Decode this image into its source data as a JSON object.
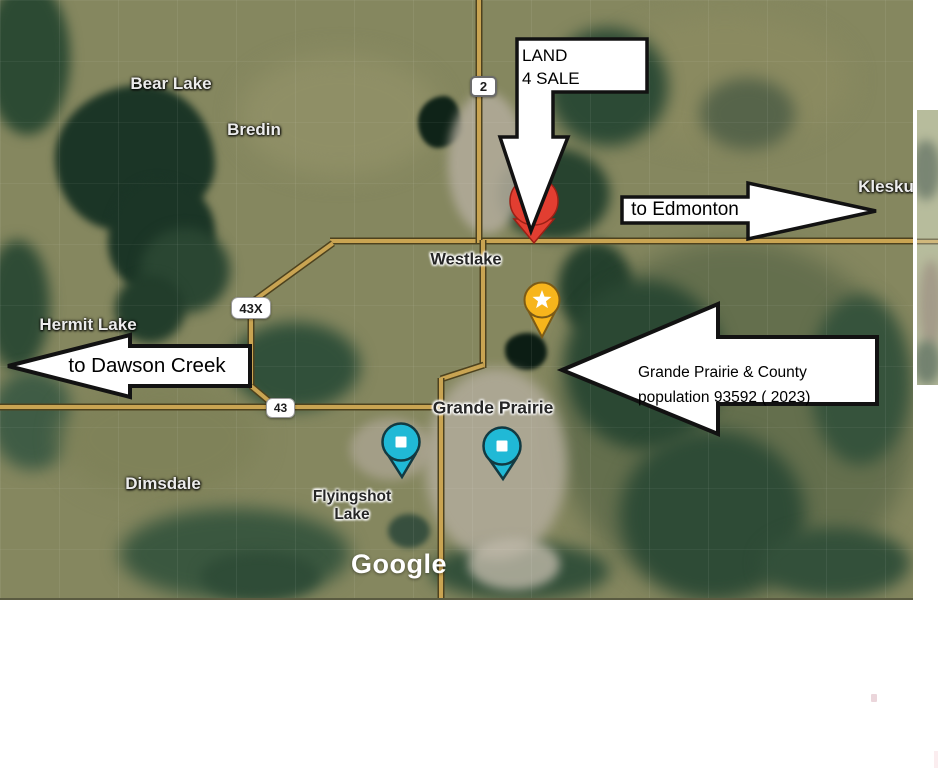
{
  "map": {
    "provider_logo": "Google",
    "labels": {
      "bear_lake": "Bear Lake",
      "bredin": "Bredin",
      "hermit_lake": "Hermit Lake",
      "westlake": "Westlake",
      "grande_prairie": "Grande Prairie",
      "dimsdale": "Dimsdale",
      "flyingshot_line1": "Flyingshot",
      "flyingshot_line2": "Lake",
      "kleskun": "Klesku"
    },
    "route_badges": {
      "hwy_2": "2",
      "hwy_43x": "43X",
      "hwy_43": "43"
    },
    "markers": {
      "red_pin": {
        "icon": "red-place-pin",
        "color": "#e23e31"
      },
      "star_pin": {
        "icon": "star-pin",
        "color": "#f7b51c"
      },
      "teal_pin_west": {
        "icon": "teal-square-pin",
        "color": "#20b9d6"
      },
      "teal_pin_east": {
        "icon": "teal-square-pin",
        "color": "#20b9d6"
      }
    }
  },
  "callouts": {
    "land_sale": {
      "line1": "LAND",
      "line2": "4 SALE"
    },
    "to_edmonton": "to Edmonton",
    "to_dawson_creek": "to Dawson Creek",
    "county": {
      "line1": "Grande Prairie & County",
      "line2": "population 93592 ( 2023)"
    }
  },
  "colors": {
    "callout_fill": "#ffffff",
    "callout_stroke": "#121212",
    "road": "#c9a452",
    "red_pin": "#e23e31",
    "star_pin": "#f7b51c",
    "teal_pin": "#20b9d6"
  }
}
